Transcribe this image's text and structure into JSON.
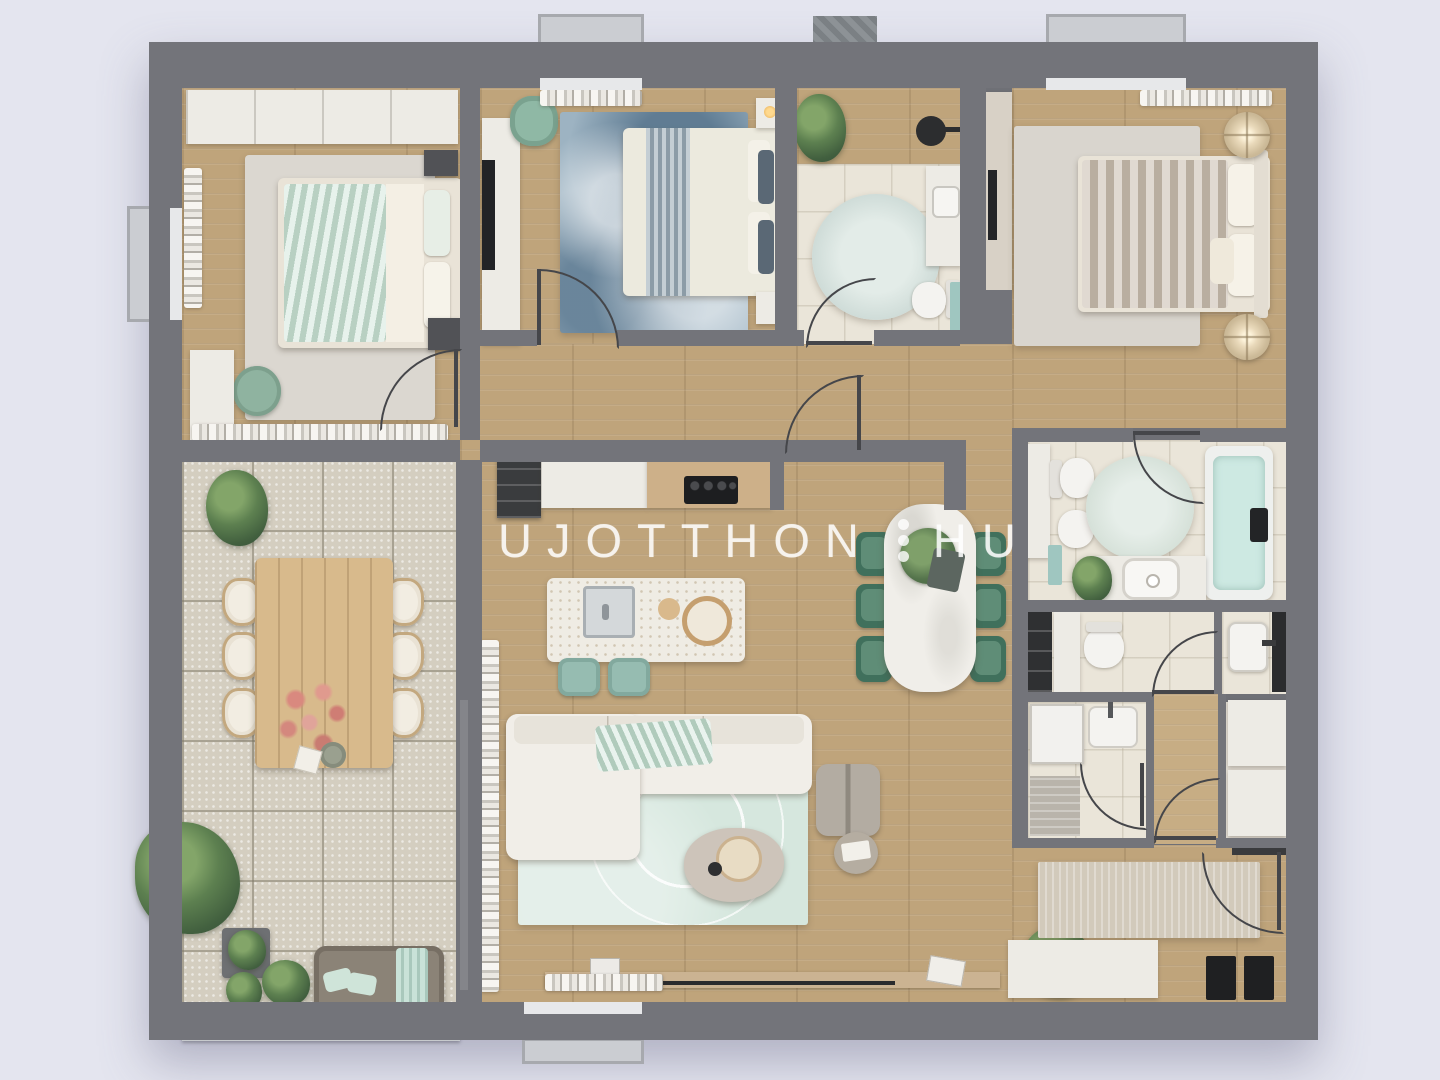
{
  "watermark": {
    "brand_left": "UJOTTHON",
    "brand_right": "HU",
    "separator": "vertical-three-dots",
    "separator_dot_count": 3
  },
  "palette": {
    "page_background": "#e4e5ef",
    "walls": "#73747a",
    "wood_floor": "#bfa47b",
    "terrace_stone": "#d4cec0",
    "bathroom_tile": "#eae5d9",
    "accent_mint": "#cfe4d9",
    "accent_teal_stool": "#96bcb1",
    "dining_chair_green": "#40705c",
    "rug_blue": "#9db3c2",
    "tub_water": "#cde9e2",
    "marble_white": "#f0eee9"
  },
  "floorplan": {
    "type": "apartment-top-view-3d-render",
    "rooms": [
      {
        "id": "bedroom-1",
        "position": "top-left",
        "key_items": [
          "double-bed-mint-bedding",
          "grey-area-rug",
          "white-wardrobe",
          "green-pouf",
          "dresser",
          "window-curtains"
        ]
      },
      {
        "id": "bedroom-2",
        "position": "top-center-left",
        "key_items": [
          "double-bed-white-duvet-blue-runner",
          "blue-watercolor-rug",
          "tv-unit",
          "green-armchair",
          "two-nightstands"
        ]
      },
      {
        "id": "bathroom-top",
        "position": "top-center-right",
        "key_items": [
          "round-rug",
          "toilet",
          "vanity-sink",
          "teal-cabinet",
          "plant",
          "black-pendant"
        ]
      },
      {
        "id": "master-bedroom",
        "position": "top-right",
        "key_items": [
          "double-bed-taupe-duvet",
          "two-round-bedside-lamps",
          "area-rug",
          "dresser-strip",
          "curtains"
        ]
      },
      {
        "id": "kitchen",
        "position": "center",
        "key_items": [
          "white-counter",
          "black-cooktop",
          "dark-open-shelf",
          "terrazzo-island-with-sink",
          "two-teal-stools"
        ]
      },
      {
        "id": "dining-area",
        "position": "center-right",
        "key_items": [
          "white-marble-table",
          "six-green-chairs",
          "salad-platter"
        ]
      },
      {
        "id": "living-room",
        "position": "bottom-center",
        "key_items": [
          "white-l-shaped-sofa",
          "mint-leaf-rug",
          "stone-coffee-table",
          "grey-lounge-chair",
          "side-table",
          "media-ledge",
          "plant"
        ]
      },
      {
        "id": "terrace",
        "position": "left",
        "key_items": [
          "wooden-dining-table",
          "six-cream-chairs",
          "pink-flowers",
          "potted-plants",
          "grey-daybed-mint-pillows",
          "balustrade"
        ]
      },
      {
        "id": "main-bathroom",
        "position": "right-middle",
        "key_items": [
          "bathtub-filled",
          "round-mint-rug",
          "toilet",
          "bidet",
          "vessel-sink-vanity",
          "tall-cabinet",
          "plant"
        ]
      },
      {
        "id": "wc",
        "position": "right-lower",
        "key_items": [
          "toilet",
          "black-shelving",
          "wall-hung-basin"
        ]
      },
      {
        "id": "shower-room",
        "position": "right-lower",
        "key_items": [
          "shower-glass",
          "basin",
          "shower-tray"
        ]
      },
      {
        "id": "inner-hallway",
        "position": "right-lower",
        "key_items": [
          "wood-floor",
          "closet-sliding-doors"
        ]
      },
      {
        "id": "entry-hall",
        "position": "bottom-right",
        "key_items": [
          "runner-rug",
          "entry-door",
          "white-sideboard",
          "two-black-mats"
        ]
      }
    ]
  }
}
